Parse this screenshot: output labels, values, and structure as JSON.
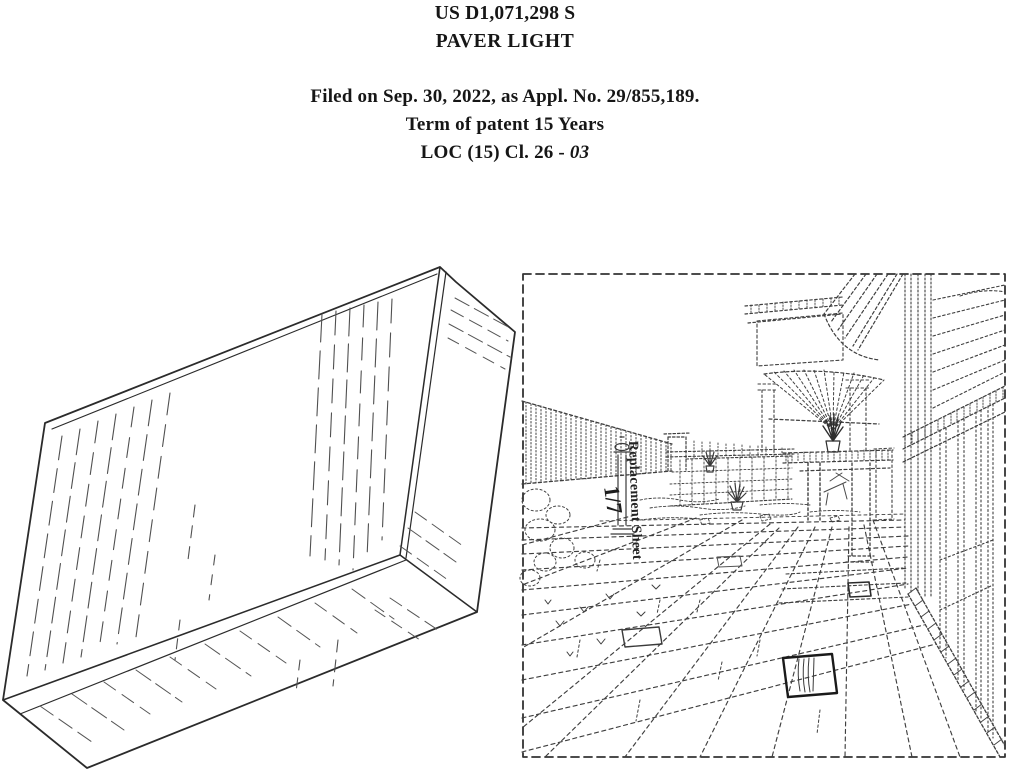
{
  "header": {
    "patent_number": "US D1,071,298 S",
    "title": "PAVER LIGHT",
    "filed_line": "Filed on Sep. 30, 2022, as Appl. No. 29/855,189.",
    "term_line": "Term of patent 15 Years",
    "loc_prefix": "LOC (15) Cl. 26 - ",
    "loc_class": "03"
  },
  "figures": {
    "perspective": {
      "name": "paver-light-perspective-view"
    },
    "environment": {
      "name": "paver-light-installed-environment-view",
      "sheet_label": "Replacement Sheet",
      "sheet_number": "1/7"
    }
  },
  "colors": {
    "page_bg": "#ffffff",
    "ink": "#161616",
    "outline": "#2b2b2b",
    "hatch": "#555555",
    "dashed_line": "#3f3f3f"
  }
}
